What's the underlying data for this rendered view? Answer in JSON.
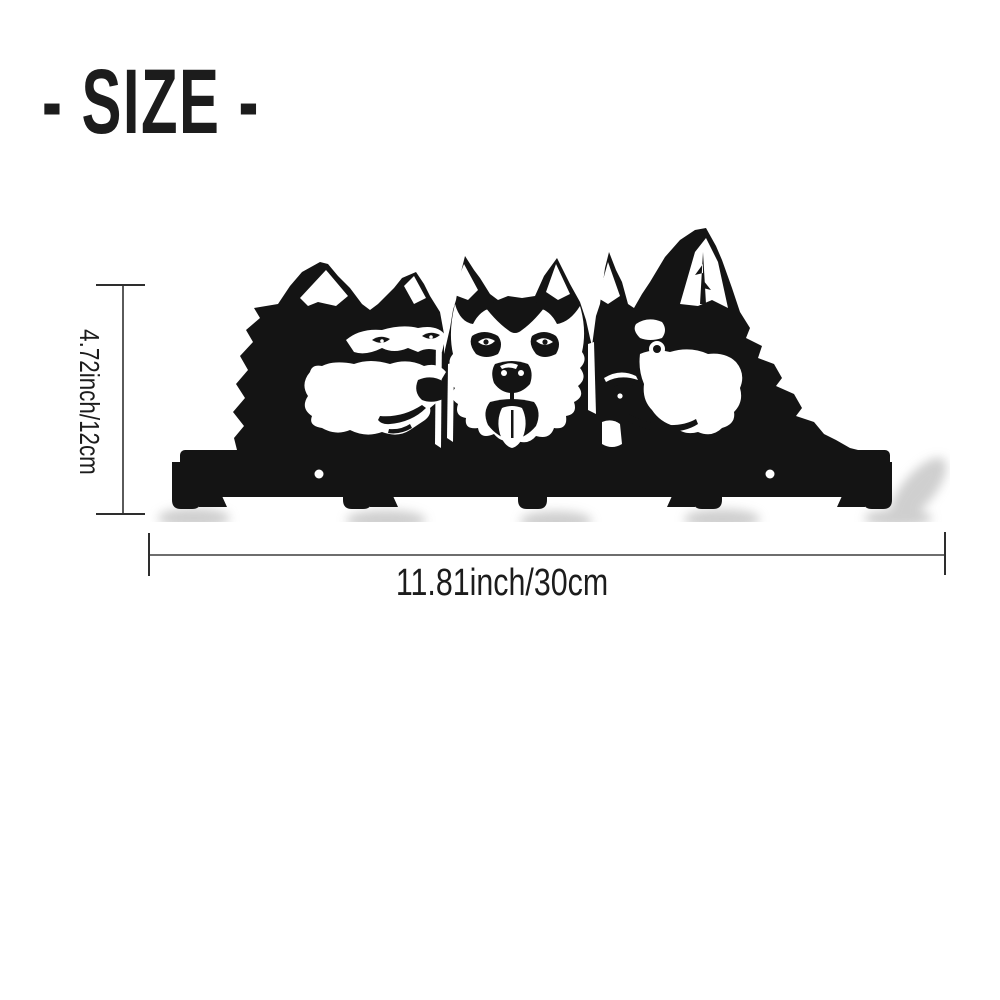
{
  "title": {
    "text": "- SIZE -"
  },
  "dimensions": {
    "height": {
      "label": "4.72inch/12cm"
    },
    "width": {
      "label": "11.81inch/30cm"
    }
  },
  "product": {
    "name": "Husky dogs wall key holder",
    "hooks": 5,
    "screw_holes": 2
  },
  "colors": {
    "ink": "#141414",
    "paper": "#ffffff",
    "shadow": "#a8a8a8",
    "dim_line": "#5a5a5a",
    "dim_tick": "#2e2e2e",
    "text": "#1c1c1c"
  }
}
